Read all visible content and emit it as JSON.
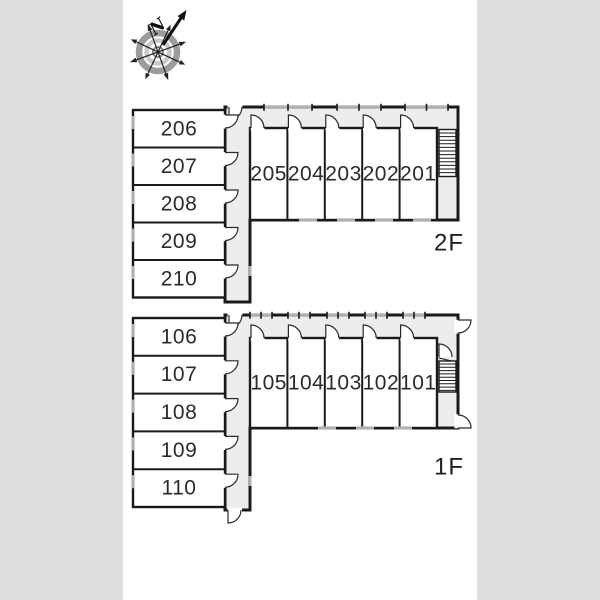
{
  "compass": {
    "label": "N"
  },
  "floors": [
    {
      "label": "2F",
      "vertical_rooms": [
        "206",
        "207",
        "208",
        "209",
        "210"
      ],
      "horizontal_rooms": [
        "205",
        "204",
        "203",
        "202",
        "201"
      ]
    },
    {
      "label": "1F",
      "vertical_rooms": [
        "106",
        "107",
        "108",
        "109",
        "110"
      ],
      "horizontal_rooms": [
        "105",
        "104",
        "103",
        "102",
        "101"
      ]
    }
  ],
  "colors": {
    "canvas_background": "#dedede",
    "page_background": "#ffffff",
    "wall": "#1a1a1a",
    "corridor_fill": "#ededed",
    "room_fill": "#ffffff",
    "window_mark": "#b0b0b0",
    "label_text": "#2b2b2b"
  }
}
